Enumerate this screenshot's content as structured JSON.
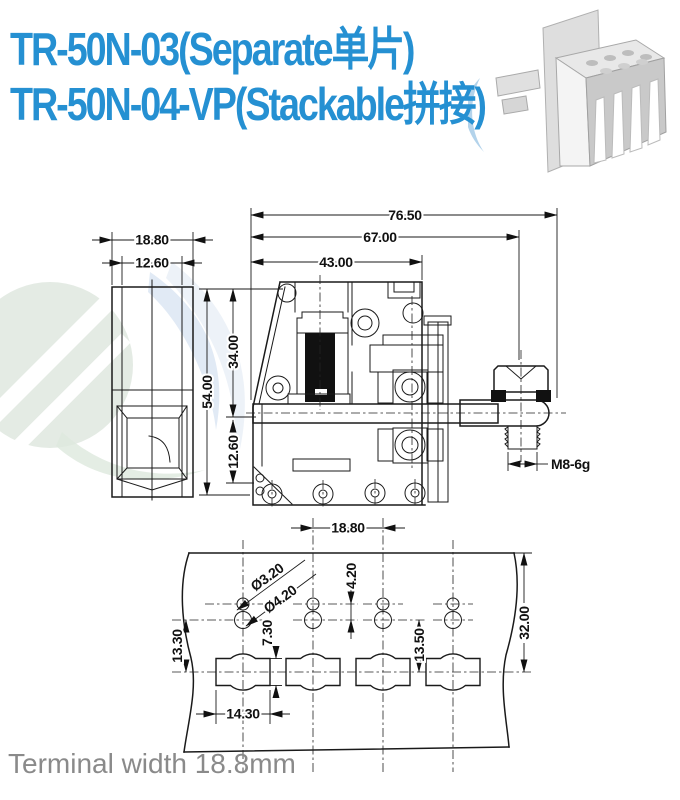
{
  "title": {
    "line1": "TR-50N-03(Separate单片)",
    "line2": "TR-50N-04-VP(Stackable拼接)",
    "models": [
      "TR-50N-03",
      "TR-50N-04-VP"
    ],
    "variants": [
      "Separate 单片",
      "Stackable 拼接"
    ]
  },
  "footer": {
    "note": "Terminal width 18.8mm"
  },
  "colors": {
    "title_blue": "#2590d2",
    "drawing_line": "#1a1a1a",
    "footer_gray": "#8a8a8a",
    "watermark_green": "#dfe8df",
    "watermark_blue": "#d9e5f2"
  },
  "drawing": {
    "side_view": {
      "outer_width": "18.80",
      "inner_width": "12.60"
    },
    "section": {
      "len_total": "76.50",
      "len_mid": "67.00",
      "len_body": "43.00",
      "h_total": "54.00",
      "h_upper": "34.00",
      "h_lower": "12.60",
      "thread": "M8-6g"
    },
    "footprint": {
      "pitch": "18.80",
      "small_hole": "Ø3.20",
      "big_hole": "Ø4.20",
      "row_gap": "4.20",
      "slot_h": "7.30",
      "right_off": "13.50",
      "left_off": "13.30",
      "slot_w": "14.30",
      "strip_h": "32.00"
    }
  }
}
